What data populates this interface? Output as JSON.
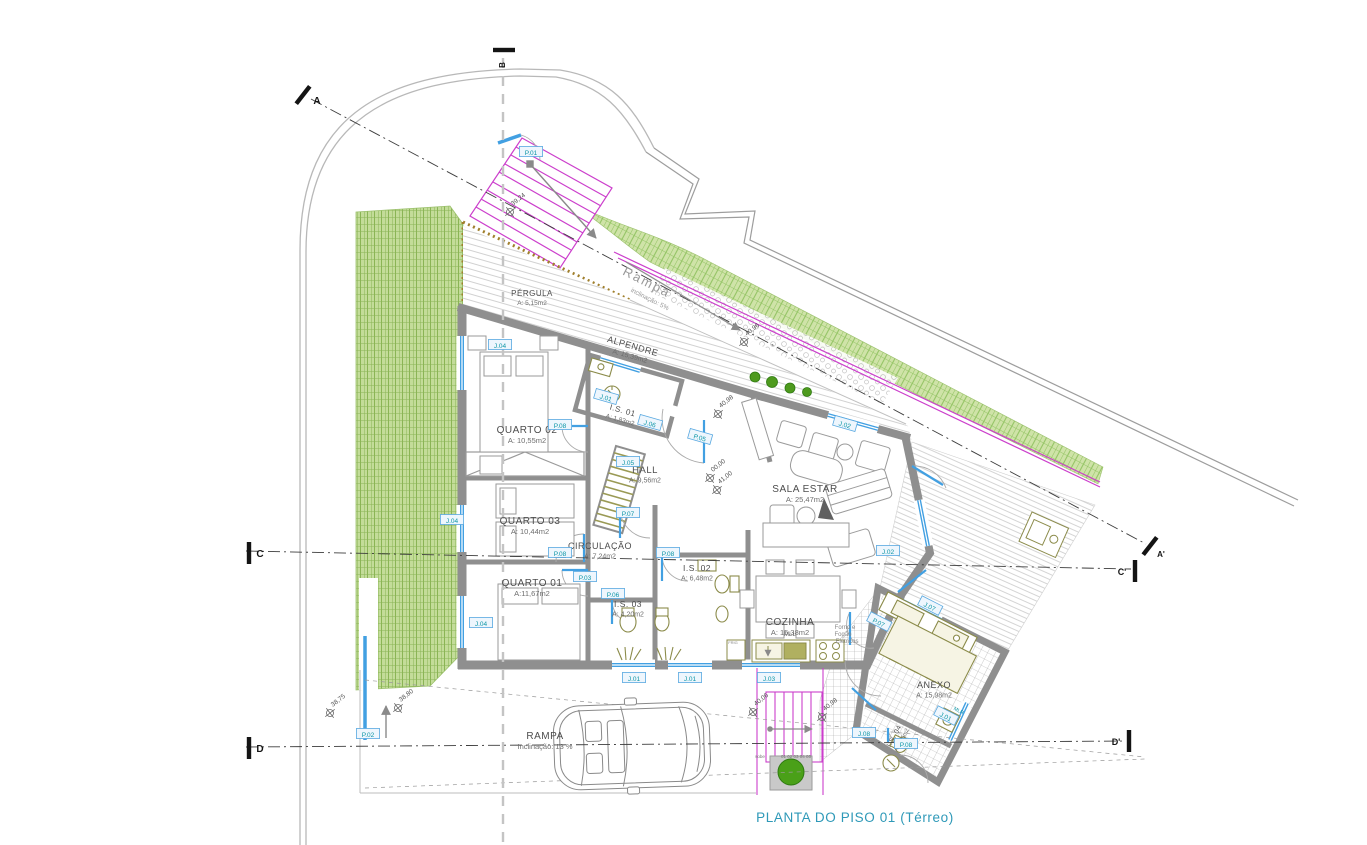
{
  "title": "PLANTA DO PISO 01 (Térreo)",
  "colors": {
    "wall": "#8f8f8f",
    "window_blue": "#42a0e2",
    "tag_teal": "#0d96a6",
    "tag_border": "#58a8e0",
    "magenta": "#cc3fcc",
    "lawn_green": "#8fbf5a",
    "title_teal": "#2e99b8",
    "fixture_olive": "#8b8b4a"
  },
  "rooms": [
    {
      "name": "PÉRGULA",
      "area": "A: 5,15m2",
      "x": 532,
      "y": 296,
      "rot": 0,
      "size": 8,
      "asize": 6.5
    },
    {
      "name": "ALPENDRE",
      "area": "A: 15,39m2",
      "x": 632,
      "y": 349,
      "rot": 16,
      "size": 9,
      "asize": 7
    },
    {
      "name": "QUARTO 02",
      "area": "A: 10,55m2",
      "x": 527,
      "y": 433,
      "rot": 0,
      "size": 10,
      "asize": 7.5
    },
    {
      "name": "QUARTO 03",
      "area": "A: 10,44m2",
      "x": 530,
      "y": 524,
      "rot": 0,
      "size": 10,
      "asize": 7.5
    },
    {
      "name": "QUARTO 01",
      "area": "A:11,67m2",
      "x": 532,
      "y": 586,
      "rot": 0,
      "size": 10,
      "asize": 7.5
    },
    {
      "name": "I.S. 01",
      "area": "A: 1,83m2",
      "x": 622,
      "y": 413,
      "rot": 16,
      "size": 8,
      "asize": 6.5
    },
    {
      "name": "HALL",
      "area": "A: 9,56m2",
      "x": 645,
      "y": 473,
      "rot": 0,
      "size": 9.5,
      "asize": 7
    },
    {
      "name": "CIRCULAÇÃO",
      "area": "A: 7,24m2",
      "x": 600,
      "y": 549,
      "rot": 0,
      "size": 9,
      "asize": 7
    },
    {
      "name": "I.S. 02",
      "area": "A: 6,48m2",
      "x": 697,
      "y": 571,
      "rot": 0,
      "size": 8.5,
      "asize": 7
    },
    {
      "name": "I.S. 03",
      "area": "A: 4,20m2",
      "x": 628,
      "y": 607,
      "rot": 0,
      "size": 8.5,
      "asize": 7
    },
    {
      "name": "SALA ESTAR",
      "area": "A: 25,47m2",
      "x": 805,
      "y": 492,
      "rot": 0,
      "size": 10,
      "asize": 7.5
    },
    {
      "name": "COZINHA",
      "area": "A: 15,38m2",
      "x": 790,
      "y": 625,
      "rot": 0,
      "size": 10,
      "asize": 7.5
    },
    {
      "name": "ANEXO",
      "area": "A: 15,98m2",
      "x": 934,
      "y": 688,
      "rot": 0,
      "size": 9,
      "asize": 7
    },
    {
      "name": "I.S. 04",
      "area": "A: 1,95m2",
      "x": 896,
      "y": 737,
      "rot": -62,
      "size": 7,
      "asize": 5.5
    },
    {
      "name": "RAMPA",
      "area": "Inclinação: 13 %",
      "x": 545,
      "y": 739,
      "rot": 0,
      "size": 10,
      "asize": 7.5
    }
  ],
  "tags": [
    {
      "t": "P.01",
      "x": 531,
      "y": 152
    },
    {
      "t": "P.02",
      "x": 368,
      "y": 734
    },
    {
      "t": "J.04",
      "x": 500,
      "y": 345
    },
    {
      "t": "J.04",
      "x": 452,
      "y": 520
    },
    {
      "t": "J.04",
      "x": 481,
      "y": 623
    },
    {
      "t": "P.08",
      "x": 560,
      "y": 425
    },
    {
      "t": "J.01",
      "x": 606,
      "y": 397,
      "rot": 16
    },
    {
      "t": "J.06",
      "x": 650,
      "y": 423,
      "rot": 16
    },
    {
      "t": "P.05",
      "x": 700,
      "y": 437,
      "rot": 16
    },
    {
      "t": "J.05",
      "x": 628,
      "y": 462
    },
    {
      "t": "P.07",
      "x": 628,
      "y": 513
    },
    {
      "t": "P.08",
      "x": 560,
      "y": 553
    },
    {
      "t": "P.08",
      "x": 668,
      "y": 553
    },
    {
      "t": "P.03",
      "x": 585,
      "y": 577
    },
    {
      "t": "P.06",
      "x": 613,
      "y": 594
    },
    {
      "t": "J.02",
      "x": 845,
      "y": 424,
      "rot": 16
    },
    {
      "t": "J.02",
      "x": 888,
      "y": 551
    },
    {
      "t": "P.07",
      "x": 879,
      "y": 622,
      "rot": 27
    },
    {
      "t": "J.07",
      "x": 930,
      "y": 606,
      "rot": 27
    },
    {
      "t": "J.01",
      "x": 946,
      "y": 716,
      "rot": 27
    },
    {
      "t": "P.08",
      "x": 906,
      "y": 744
    },
    {
      "t": "J.08",
      "x": 864,
      "y": 733
    },
    {
      "t": "J.01",
      "x": 634,
      "y": 678
    },
    {
      "t": "J.01",
      "x": 690,
      "y": 678
    },
    {
      "t": "J.03",
      "x": 769,
      "y": 678
    }
  ],
  "dims": [
    {
      "t": "39,24",
      "x": 510,
      "y": 212,
      "rot": -38
    },
    {
      "t": "40,96",
      "x": 744,
      "y": 342,
      "rot": -38
    },
    {
      "t": "40,98",
      "x": 718,
      "y": 414,
      "rot": -38
    },
    {
      "t": "00,00",
      "x": 710,
      "y": 478,
      "rot": -38
    },
    {
      "t": "41,00",
      "x": 717,
      "y": 490,
      "rot": -38
    },
    {
      "t": "38,75",
      "x": 330,
      "y": 713,
      "rot": -38
    },
    {
      "t": "38,80",
      "x": 398,
      "y": 708,
      "rot": -38
    },
    {
      "t": "40,06",
      "x": 753,
      "y": 712,
      "rot": -38
    },
    {
      "t": "40,98",
      "x": 822,
      "y": 717,
      "rot": -38
    }
  ],
  "sections": [
    {
      "t": "A",
      "x": 303,
      "y": 95,
      "rot": 38,
      "lx": 14,
      "ly": 9,
      "ls": 10
    },
    {
      "t": "A'",
      "x": 1150,
      "y": 546,
      "rot": 38,
      "lx": 11,
      "ly": 11,
      "ls": 8
    },
    {
      "t": "B",
      "x": 504,
      "y": 50,
      "rot": 90,
      "lx": 1,
      "ly": 15,
      "ls": 8,
      "lr": -90
    },
    {
      "t": "C",
      "x": 249,
      "y": 553,
      "rot": 0,
      "lx": 11,
      "ly": 4,
      "ls": 10
    },
    {
      "t": "C'",
      "x": 1135,
      "y": 571,
      "rot": 0,
      "lx": -13,
      "ly": 4,
      "ls": 9
    },
    {
      "t": "D",
      "x": 249,
      "y": 748,
      "rot": 0,
      "lx": 11,
      "ly": 4,
      "ls": 10
    },
    {
      "t": "D'",
      "x": 1129,
      "y": 741,
      "rot": 0,
      "lx": -13,
      "ly": 4,
      "ls": 9
    }
  ],
  "misc": [
    {
      "t": "Rampa",
      "x": 645,
      "y": 286,
      "rot": 27,
      "size": 13,
      "color": "#9a9a9a",
      "spacing": 2
    },
    {
      "t": "inclinação: 5%",
      "x": 649,
      "y": 301,
      "rot": 27,
      "size": 6.5,
      "color": "#9a9a9a",
      "spacing": 0
    },
    {
      "t": "sobe",
      "x": 760,
      "y": 758,
      "rot": 0,
      "size": 4.5,
      "color": "#777777",
      "spacing": 0
    },
    {
      "t": "01  02  03  04  05",
      "x": 796,
      "y": 758,
      "rot": 0,
      "size": 4.5,
      "color": "#777777",
      "spacing": 0
    },
    {
      "t": "MLL",
      "x": 790,
      "y": 636,
      "rot": 0,
      "size": 6,
      "color": "#6b6b6b",
      "spacing": 0
    },
    {
      "t": "FRIG",
      "x": 733,
      "y": 644,
      "rot": 0,
      "size": 4,
      "color": "#888888",
      "spacing": 0
    },
    {
      "t": "Forno e",
      "x": 845,
      "y": 629,
      "rot": 0,
      "size": 6,
      "color": "#888888",
      "spacing": 0
    },
    {
      "t": "Fogão",
      "x": 843,
      "y": 636,
      "rot": 0,
      "size": 6,
      "color": "#888888",
      "spacing": 0
    },
    {
      "t": "Elétricos",
      "x": 847,
      "y": 643,
      "rot": 0,
      "size": 6,
      "color": "#888888",
      "spacing": 0
    },
    {
      "t": "MLR",
      "x": 958,
      "y": 712,
      "rot": 27,
      "size": 5,
      "color": "#0d96a6",
      "spacing": 0
    }
  ]
}
